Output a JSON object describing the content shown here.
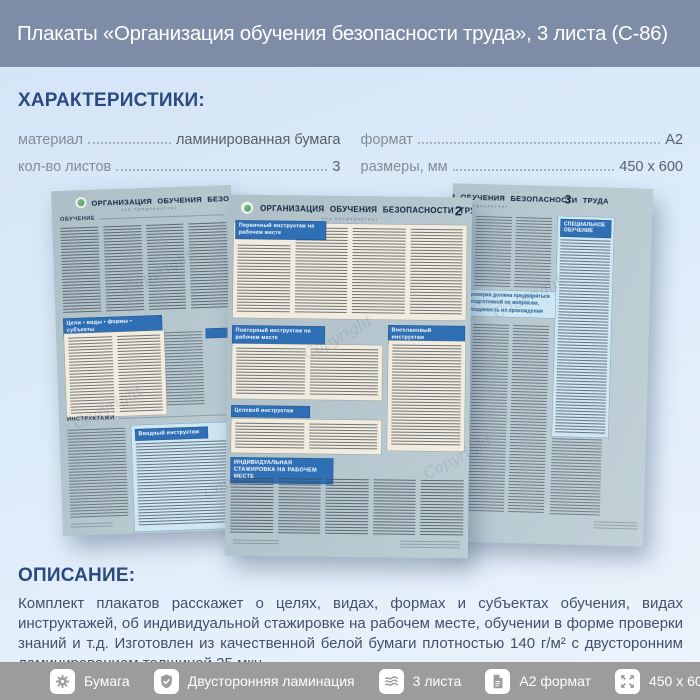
{
  "header": {
    "title": "Плакаты «Организация обучения безопасности труда», 3 листа (С-86)"
  },
  "characteristics": {
    "heading": "ХАРАКТЕРИСТИКИ:",
    "rows_left": [
      {
        "label": "материал",
        "value": "ламинированная бумага"
      },
      {
        "label": "кол-во листов",
        "value": "3"
      }
    ],
    "rows_right": [
      {
        "label": "формат",
        "value": "А2"
      },
      {
        "label": "размеры, мм",
        "value": "450 x 600"
      }
    ]
  },
  "posters": {
    "watermark": "Copyright",
    "shared_title": "ОРГАНИЗАЦИЯ ОБУЧЕНИЯ БЕЗОПАСНОСТИ ТРУДА",
    "subtitle": "(на предприятии)",
    "poster1": {
      "sections": {
        "s1": "ОБУЧЕНИЕ",
        "s2": "Цели • виды • формы • субъекты",
        "s3": "ИНСТРУКТАЖИ",
        "s4": "Вводный инструктаж"
      }
    },
    "poster2": {
      "number": "2",
      "sections": {
        "s1": "Первичный инструктаж на рабочем месте",
        "s2": "Повторный инструктаж на рабочем месте",
        "s3": "Внеплановый инструктаж",
        "s4": "Целевой инструктаж",
        "s5": "ИНДИВИДУАЛЬНАЯ СТАЖИРОВКА НА РАБОЧЕМ МЕСТЕ"
      }
    },
    "poster3": {
      "number": "3",
      "sections": {
        "s1": "СПЕЦИАЛЬНОЕ ОБУЧЕНИЕ"
      },
      "banner_lines": [
        "ая проверка должна предваряться",
        "ной подготовкой по вопросам,",
        "необходимость их прохождения"
      ]
    }
  },
  "description": {
    "heading": "ОПИСАНИЕ:",
    "text": "Комплект плакатов расскажет о целях, видах, формах и субъектах обучения, видах инструктажей, об индивидуальной стажировке на рабочем месте, обучении в форме проверки знаний и т.д. Изготовлен из качественной белой бумаги плотностью 140 г/м² с двусторонним ламинированием толщиной 25 мкн"
  },
  "footer": {
    "items": [
      {
        "icon": "gear-icon",
        "label": "Бумага"
      },
      {
        "icon": "shield-check-icon",
        "label": "Двусторонняя ламинация"
      },
      {
        "icon": "layers-icon",
        "label": "3 листа"
      },
      {
        "icon": "document-icon",
        "label": "А2 формат"
      },
      {
        "icon": "expand-arrows-icon",
        "label": "450 x 600 мм"
      }
    ]
  },
  "colors": {
    "header_bg": "#7E8CA7",
    "page_bg_top": "#D4E3F6",
    "page_bg_bottom": "#ECF4FC",
    "accent_heading": "#2A4A80",
    "footer_bg": "#9C9C9C",
    "poster_bg": "#B3C5CD",
    "poster_header_blue": "#2E6FB5",
    "panel_cream": "#F2ECDF",
    "panel_light_blue": "#CFE7F3",
    "label_gray": "#848B95",
    "value_gray": "#595F68",
    "description_text": "#42506A"
  }
}
